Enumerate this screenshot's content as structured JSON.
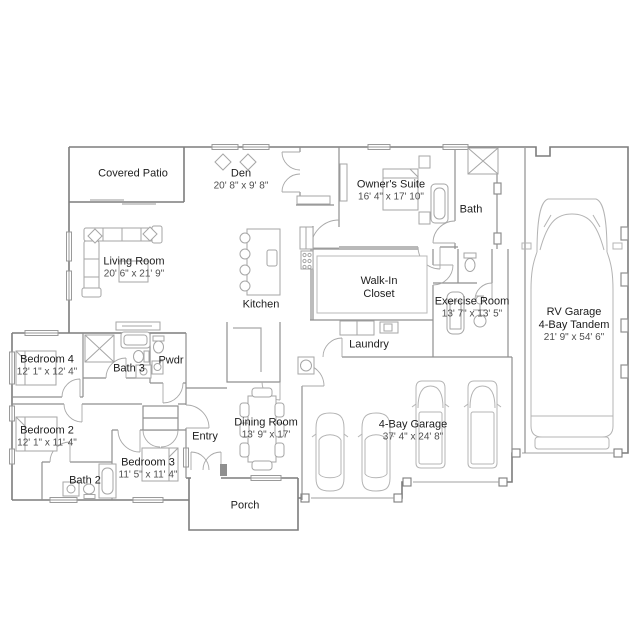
{
  "colors": {
    "exterior_wall": "#7d7d7d",
    "interior_wall": "#8f8f8f",
    "fixture_line": "#a6a6a6",
    "vehicle_line": "#b4b4b4",
    "room_name_text": "#1d1d1d",
    "dimension_text": "#4f4f4f",
    "background": "#ffffff"
  },
  "rooms": {
    "covered_patio": {
      "name": "Covered Patio"
    },
    "den": {
      "name": "Den",
      "dims": "20' 8\" x 9' 8\""
    },
    "owners_suite": {
      "name": "Owner's Suite",
      "dims": "16' 4\" x 17' 10\""
    },
    "bath": {
      "name": "Bath"
    },
    "rv_garage": {
      "name": "RV Garage",
      "name2": "4-Bay Tandem",
      "dims": "21' 9\" x 54' 6\""
    },
    "living_room": {
      "name": "Living Room",
      "dims": "20' 6\" x 21' 9\""
    },
    "kitchen": {
      "name": "Kitchen"
    },
    "walk_in_closet": {
      "name": "Walk-In",
      "name2": "Closet"
    },
    "exercise_room": {
      "name": "Exercise Room",
      "dims": "13' 7\" x 13' 5\""
    },
    "laundry": {
      "name": "Laundry"
    },
    "bedroom_4": {
      "name": "Bedroom 4",
      "dims": "12' 1\" x 12' 4\""
    },
    "bath_3": {
      "name": "Bath 3"
    },
    "pwdr": {
      "name": "Pwdr"
    },
    "bedroom_2": {
      "name": "Bedroom 2",
      "dims": "12' 1\" x 11' 4\""
    },
    "bedroom_3": {
      "name": "Bedroom 3",
      "dims": "11' 5\" x 11' 4\""
    },
    "bath_2": {
      "name": "Bath 2"
    },
    "entry": {
      "name": "Entry"
    },
    "dining_room": {
      "name": "Dining Room",
      "dims": "13' 9\" x 17'"
    },
    "porch": {
      "name": "Porch"
    },
    "four_bay_garage": {
      "name": "4-Bay Garage",
      "dims": "37' 4\" x 24' 8\""
    }
  }
}
